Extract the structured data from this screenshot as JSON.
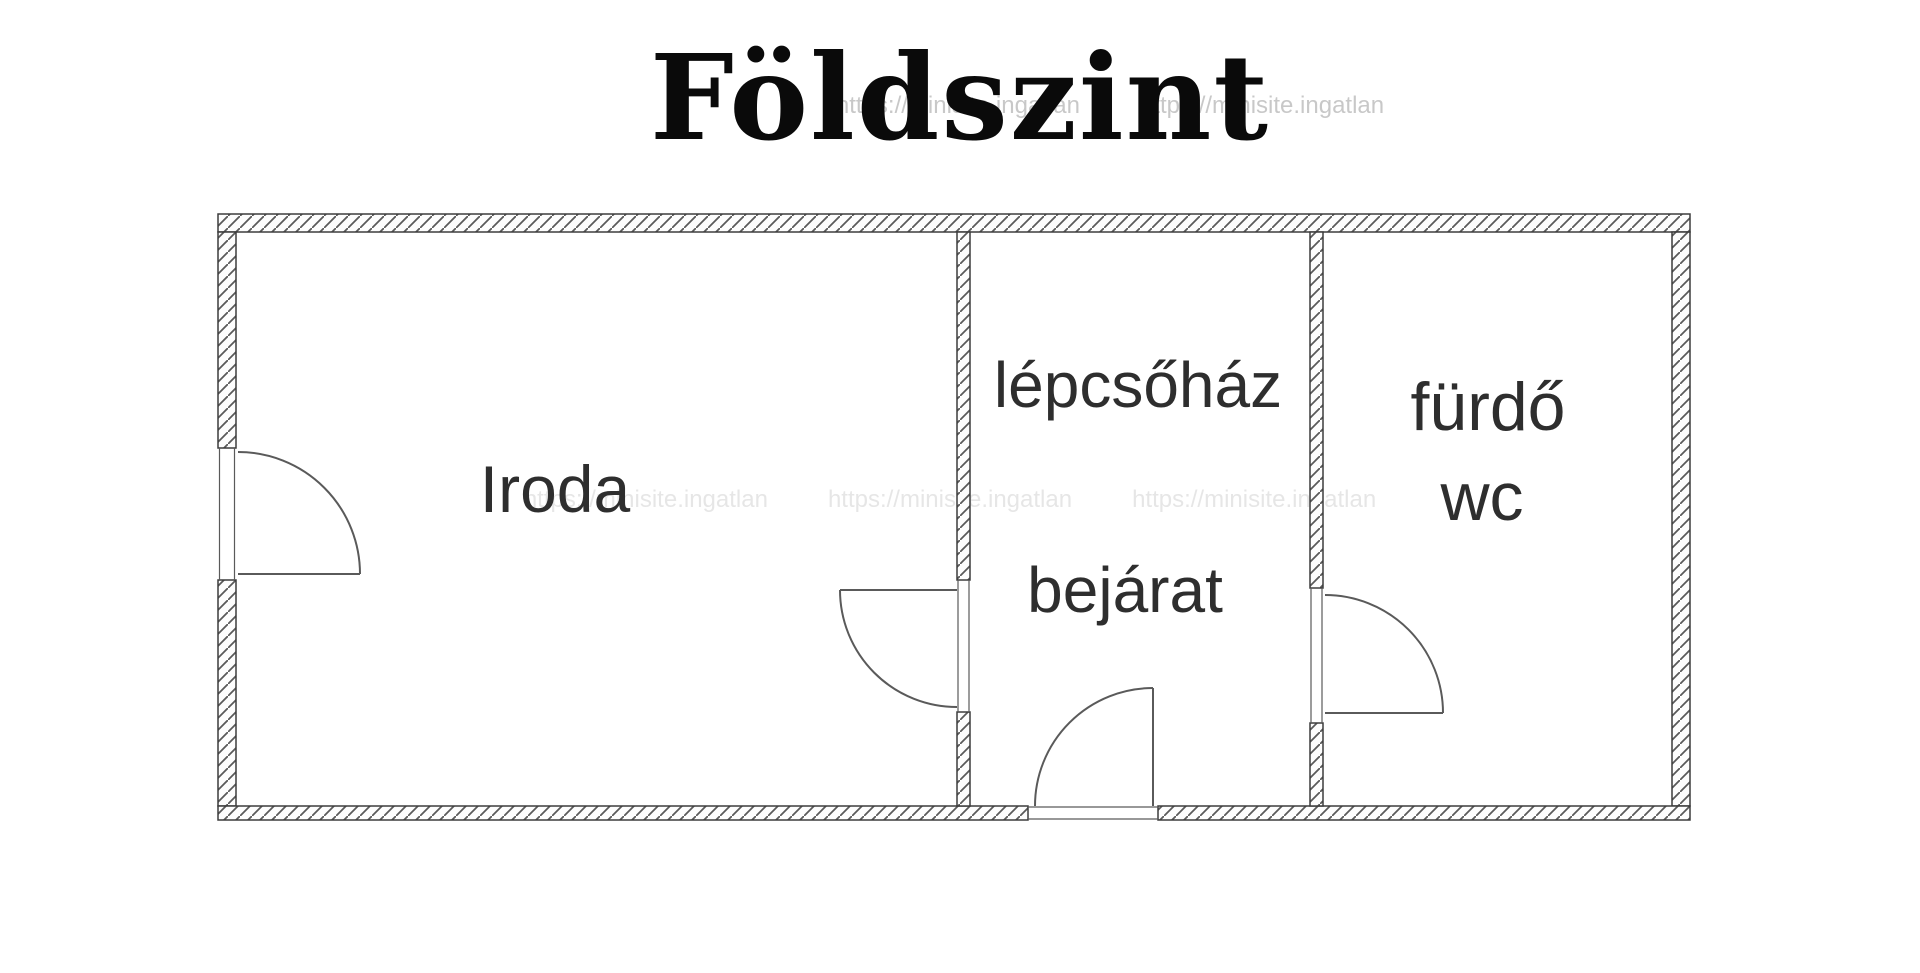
{
  "title": "Földszint",
  "watermark": {
    "url_text": "https://minisite.ingatlan"
  },
  "floor_plan": {
    "rooms": [
      {
        "id": "iroda",
        "label": "Iroda"
      },
      {
        "id": "lepcsohaz",
        "label": "lépcsőház"
      },
      {
        "id": "bejarat",
        "label": "bejárat"
      },
      {
        "id": "furdo",
        "label": "fürdő"
      },
      {
        "id": "wc",
        "label": "wc"
      }
    ],
    "door_count": 4
  },
  "colors": {
    "background": "#ffffff",
    "wall_outline": "#3d3d3d",
    "hatch_line": "#5a5a5a",
    "door_line": "#5a5a5a",
    "label_ink": "#2e2e2e",
    "title_ink": "#0a0a0a",
    "watermark_ink": "#9a9a9a"
  }
}
